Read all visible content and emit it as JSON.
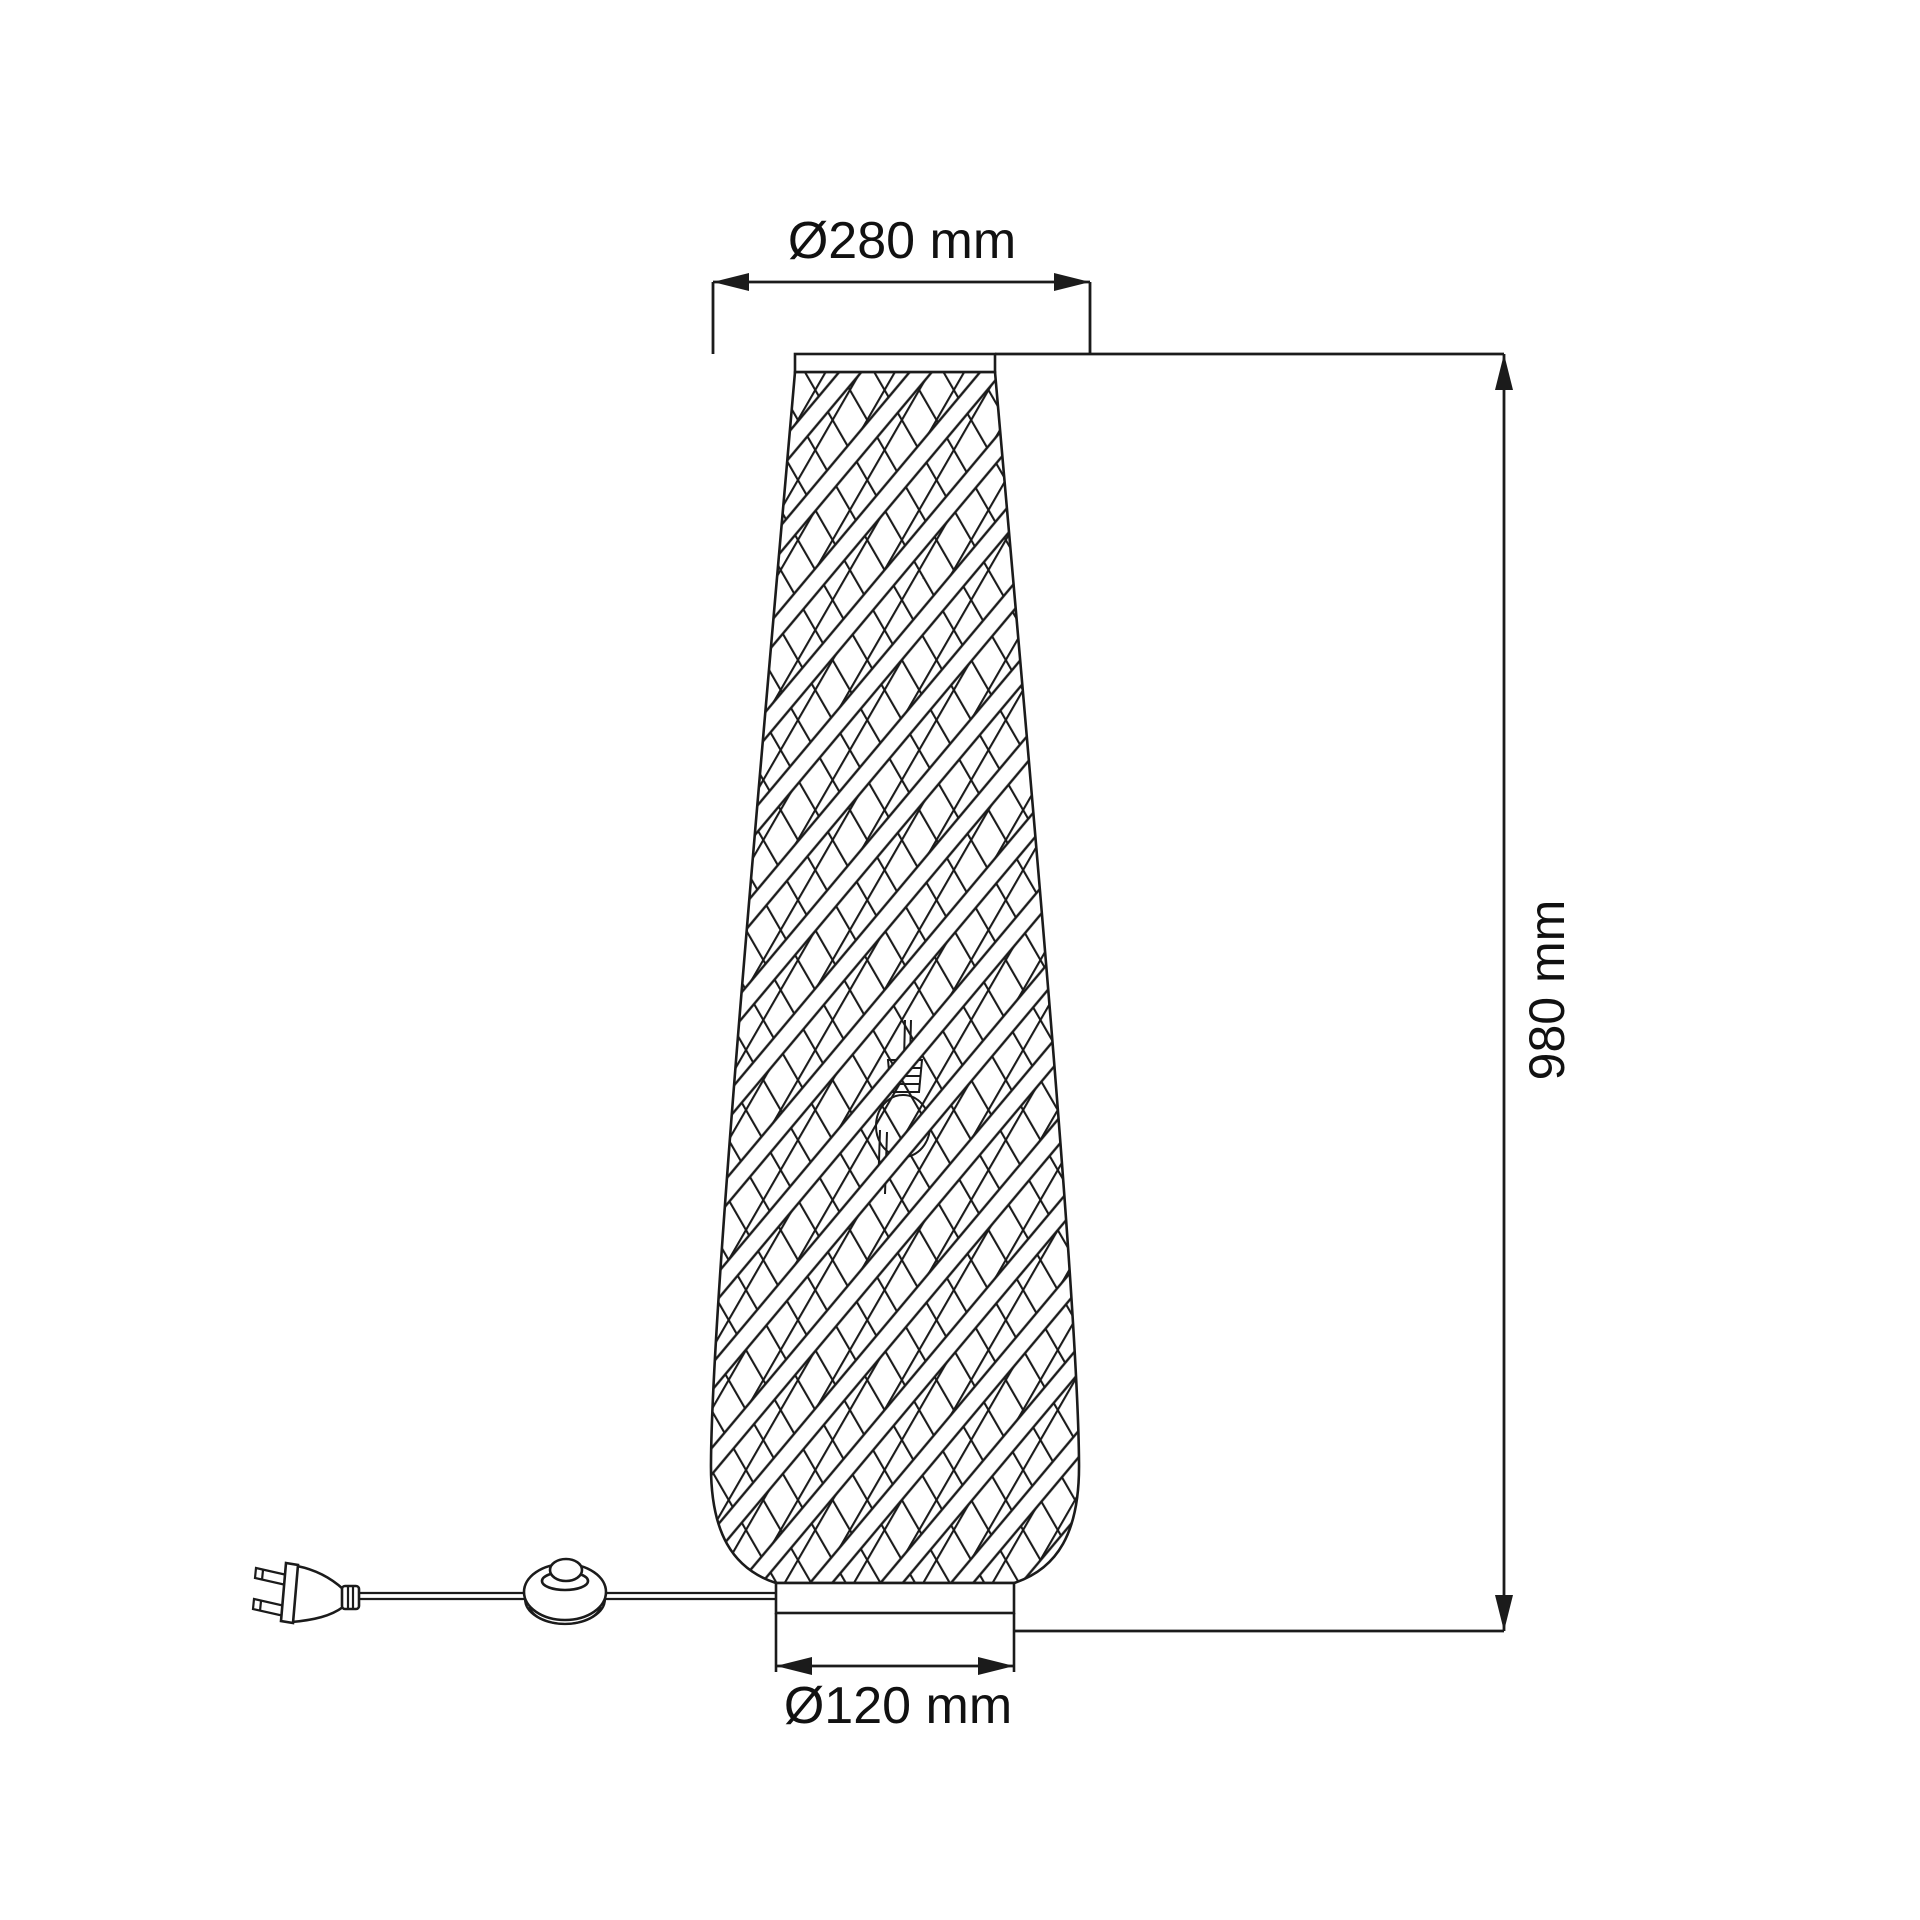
{
  "title": "Floor lamp dimensional technical drawing",
  "colors": {
    "bg": "#ffffff",
    "line": "#1b1b1b",
    "text": "#111111"
  },
  "labels": {
    "top_diameter": "Ø280 mm",
    "base_diameter": "Ø120 mm",
    "height": "980 mm"
  }
}
